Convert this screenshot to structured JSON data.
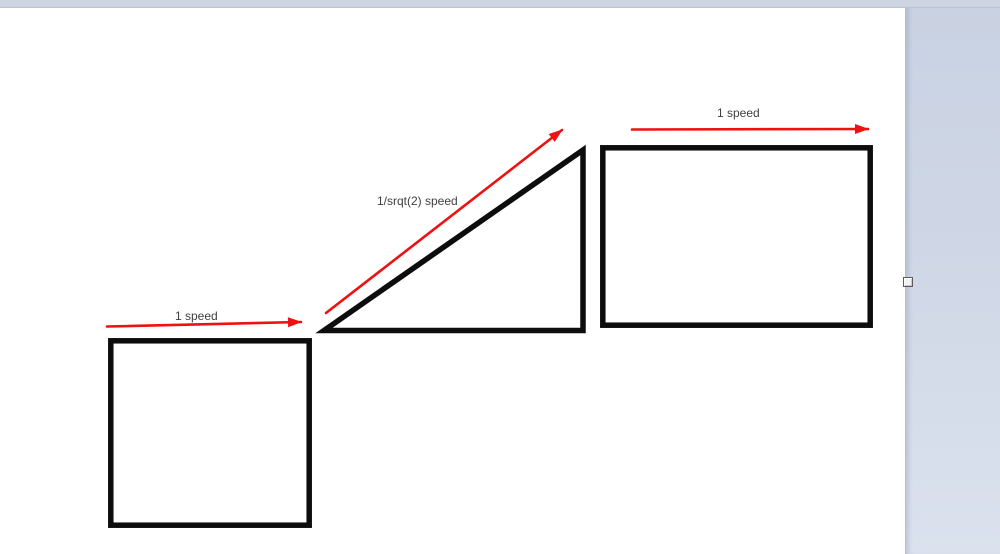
{
  "diagram": {
    "labels": {
      "square_arrow": "1 speed",
      "ramp_arrow": "1/srqt(2) speed",
      "rect_arrow": "1 speed"
    },
    "colors": {
      "arrow_red": "#ee1111",
      "shape_stroke": "#0d0d0d",
      "label_text": "#3f3f3f"
    }
  }
}
